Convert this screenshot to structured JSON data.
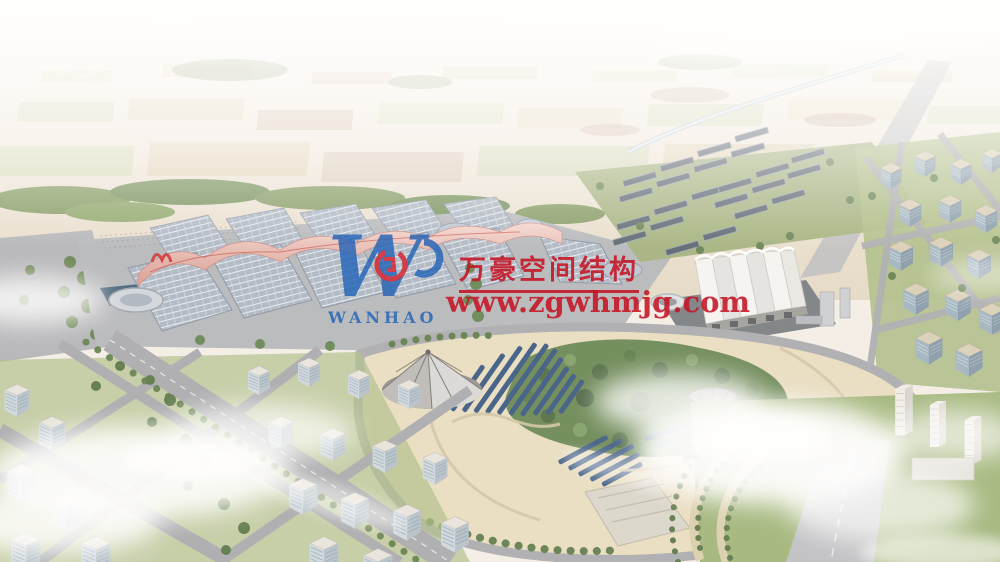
{
  "scene": {
    "description": "Aerial architectural rendering of an exhibition-center campus: rows of barrel-vaulted halls with pink membrane canopies, a white ridged membrane hall, solar-panel fields, a landscaped park with conical tent structures, surrounded by city blocks, farmland horizon and clouds"
  },
  "watermark": {
    "logo_letter": "W",
    "logo_text": "WANHAO",
    "company_name": "万豪空间结构",
    "website": "www.zgwhmjg.com",
    "text_color": "#c41323",
    "logo_blue": "#2363b6",
    "logo_red": "#d7202a"
  }
}
